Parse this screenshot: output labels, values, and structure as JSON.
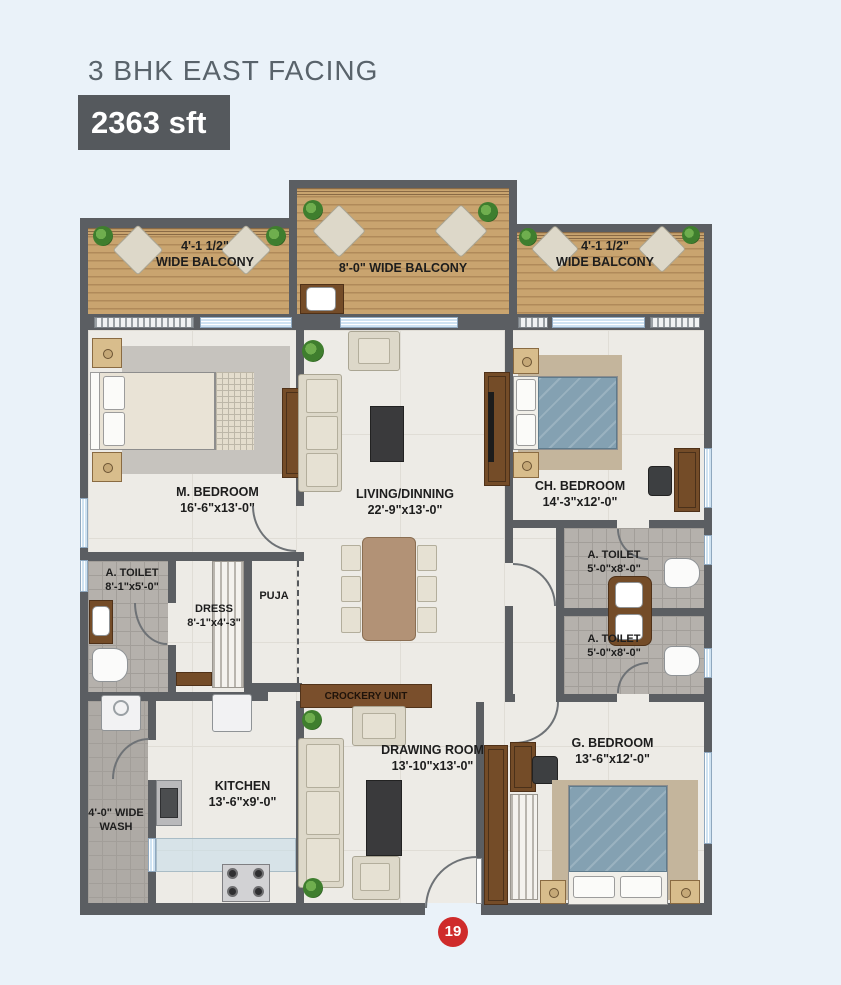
{
  "header": {
    "title": "3 BHK EAST FACING",
    "area_badge": "2363 sft"
  },
  "rooms": {
    "balcony_left": {
      "line1": "4'-1 1/2\"",
      "line2": "WIDE BALCONY"
    },
    "balcony_center": {
      "line1": "8'-0\" WIDE BALCONY"
    },
    "balcony_right": {
      "line1": "4'-1 1/2\"",
      "line2": "WIDE BALCONY"
    },
    "m_bedroom": {
      "name": "M. BEDROOM",
      "dims": "16'-6\"x13'-0\""
    },
    "living": {
      "name": "LIVING/DINNING",
      "dims": "22'-9\"x13'-0\""
    },
    "ch_bedroom": {
      "name": "CH. BEDROOM",
      "dims": "14'-3\"x12'-0\""
    },
    "a_toilet_left": {
      "name": "A. TOILET",
      "dims": "8'-1\"x5'-0\""
    },
    "dress": {
      "name": "DRESS",
      "dims": "8'-1\"x4'-3\""
    },
    "puja": {
      "name": "PUJA"
    },
    "a_toilet_top": {
      "name": "A. TOILET",
      "dims": "5'-0\"x8'-0\""
    },
    "a_toilet_bottom": {
      "name": "A. TOILET",
      "dims": "5'-0\"x8'-0\""
    },
    "crockery_unit": {
      "name": "CROCKERY UNIT"
    },
    "wash": {
      "line1": "4'-0\" WIDE",
      "line2": "WASH"
    },
    "kitchen": {
      "name": "KITCHEN",
      "dims": "13'-6\"x9'-0\""
    },
    "drawing_room": {
      "name": "DRAWING ROOM",
      "dims": "13'-10\"x13'-0\""
    },
    "g_bedroom": {
      "name": "G. BEDROOM",
      "dims": "13'-6\"x12'-0\""
    }
  },
  "marker": {
    "number": "19"
  },
  "colors": {
    "background": "#eaf2f9",
    "wall": "#5b5e62",
    "wood_floor": "#c9a46f",
    "marble_floor": "#edebe6",
    "tile_floor": "#b5b1ac",
    "window": "#cfe3f2",
    "badge_bg": "#55595d",
    "badge_text": "#ffffff",
    "title_text": "#59636b",
    "label_text": "#1d1d1d",
    "marker_red": "#cf2b2b"
  }
}
